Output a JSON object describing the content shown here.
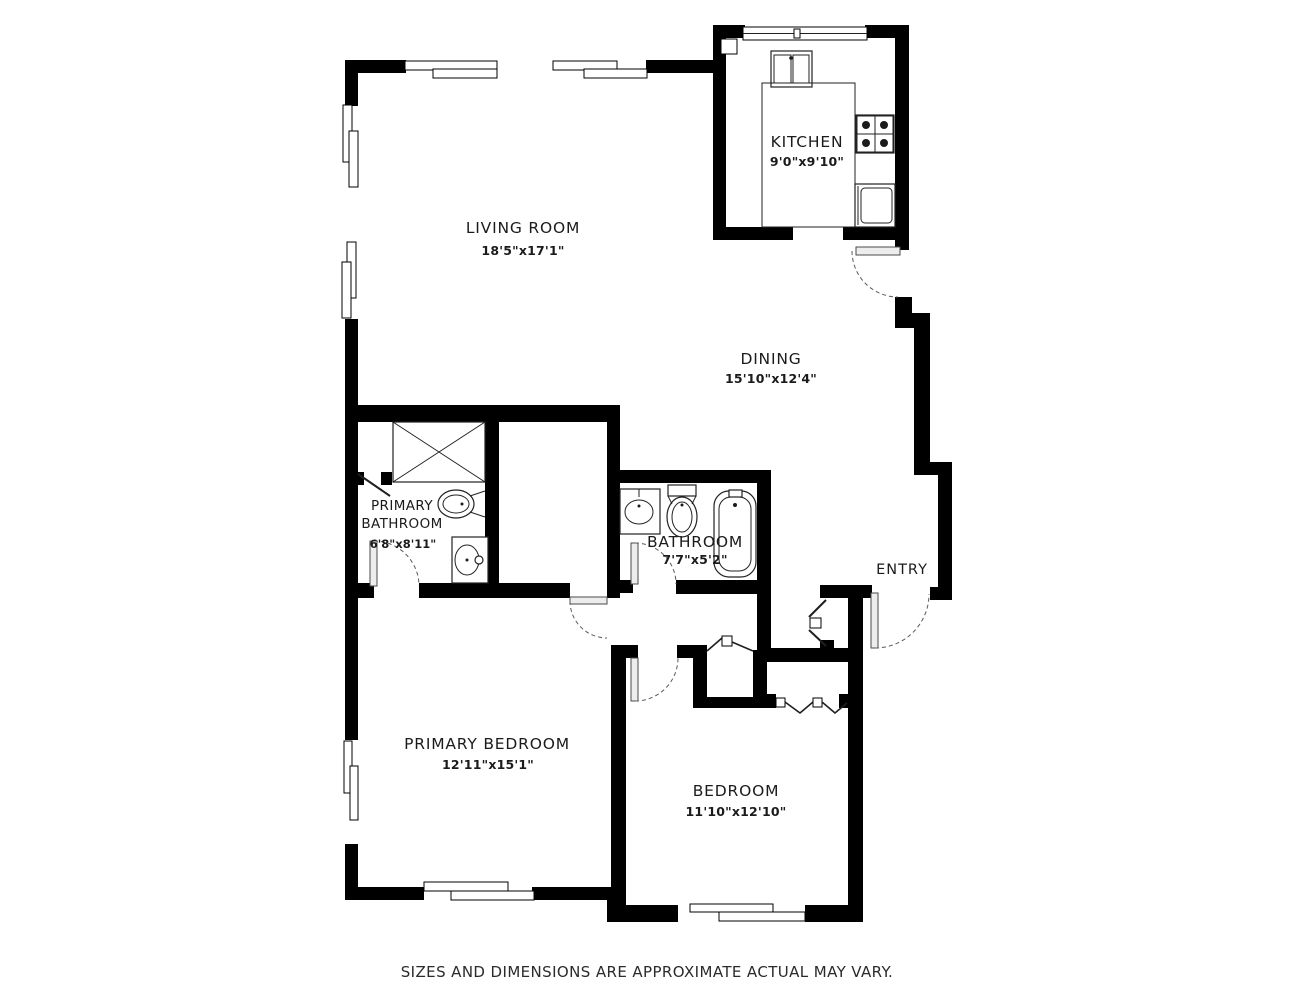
{
  "plan": {
    "rooms": [
      {
        "id": "kitchen",
        "name": "KITCHEN",
        "dims": "9'0\"x9'10\""
      },
      {
        "id": "living-room",
        "name": "LIVING ROOM",
        "dims": "18'5\"x17'1\""
      },
      {
        "id": "dining",
        "name": "DINING",
        "dims": "15'10\"x12'4\""
      },
      {
        "id": "primary-bathroom",
        "name_line1": "PRIMARY",
        "name_line2": "BATHROOM",
        "dims": "6'8\"x8'11\""
      },
      {
        "id": "bathroom",
        "name": "BATHROOM",
        "dims": "7'7\"x5'2\""
      },
      {
        "id": "entry",
        "name": "ENTRY"
      },
      {
        "id": "primary-bedroom",
        "name": "PRIMARY BEDROOM",
        "dims": "12'11\"x15'1\""
      },
      {
        "id": "bedroom",
        "name": "BEDROOM",
        "dims": "11'10\"x12'10\""
      }
    ],
    "footer": {
      "disclaimer": "SIZES AND DIMENSIONS ARE APPROXIMATE ACTUAL MAY VARY."
    },
    "fixtures": [
      "shower-icon",
      "toilet-icon",
      "sink-icon",
      "bathtub-icon",
      "kitchen-sink-icon",
      "stove-icon",
      "oven-icon",
      "counter-icon",
      "window-icon",
      "door-swing-icon",
      "closet-bifold-icon"
    ],
    "colors": {
      "wall": "#000000",
      "background": "#ffffff",
      "fixture_line": "#222222",
      "text": "#1b1b1b"
    }
  }
}
